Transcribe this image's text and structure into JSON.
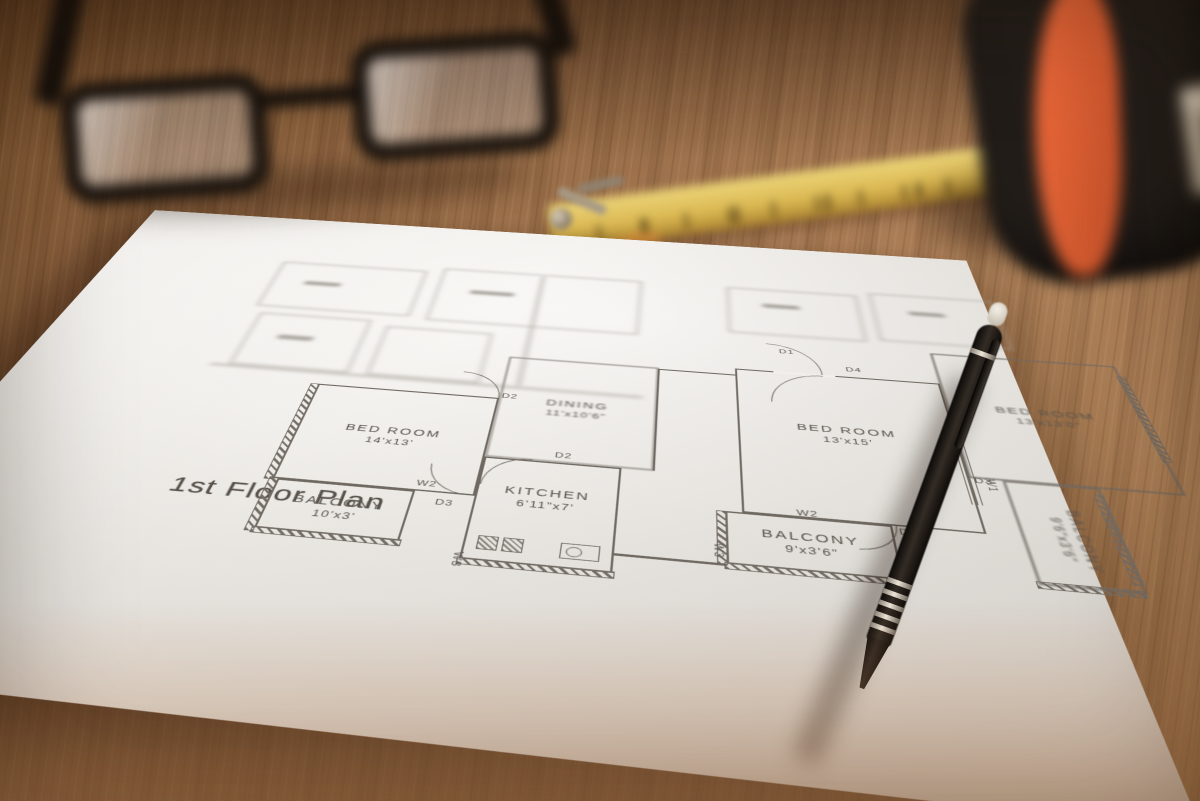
{
  "scene": {
    "objects": [
      "wooden-table",
      "floor-plan-sheet",
      "eyeglasses",
      "folding-ruler",
      "tape-measure",
      "pen"
    ],
    "colors": {
      "wood": "#9a6b44",
      "paper": "#f1efeb",
      "plan_line": "#6f6962",
      "ruler_yellow": "#d9b85a",
      "tape_body": "#221d19",
      "tape_accent": "#e0592f",
      "pen_black": "#151110",
      "glasses_frame": "#17110c"
    }
  },
  "floor_plan": {
    "title": "1st Floor Plan",
    "left_unit": {
      "bedroom": {
        "name": "BED ROOM",
        "dims": "14'x13'"
      },
      "balcony": {
        "name": "BALCONY",
        "dims": "10'x3'"
      },
      "kitchen": {
        "name": "KITCHEN",
        "dims": "6'11\"x7'"
      },
      "dining": {
        "name": "DINING",
        "dims": "11'x10'6\""
      }
    },
    "right_unit": {
      "bedroom": {
        "name": "BED ROOM",
        "dims": "13'x15'"
      },
      "balcony": {
        "name": "BALCONY",
        "dims": "9'x3'6\""
      },
      "bedroom_rear": {
        "name": "BED ROOM",
        "dims": "13'x13'0\""
      },
      "balcony_rear": {
        "name": "BALCONY",
        "dims": "9'6\"x3'6\""
      }
    },
    "markers": {
      "w1": "W1",
      "w2": "W2",
      "w3": "W3",
      "d1": "D1",
      "d2": "D2",
      "d3": "D3",
      "d4": "D4"
    }
  }
}
